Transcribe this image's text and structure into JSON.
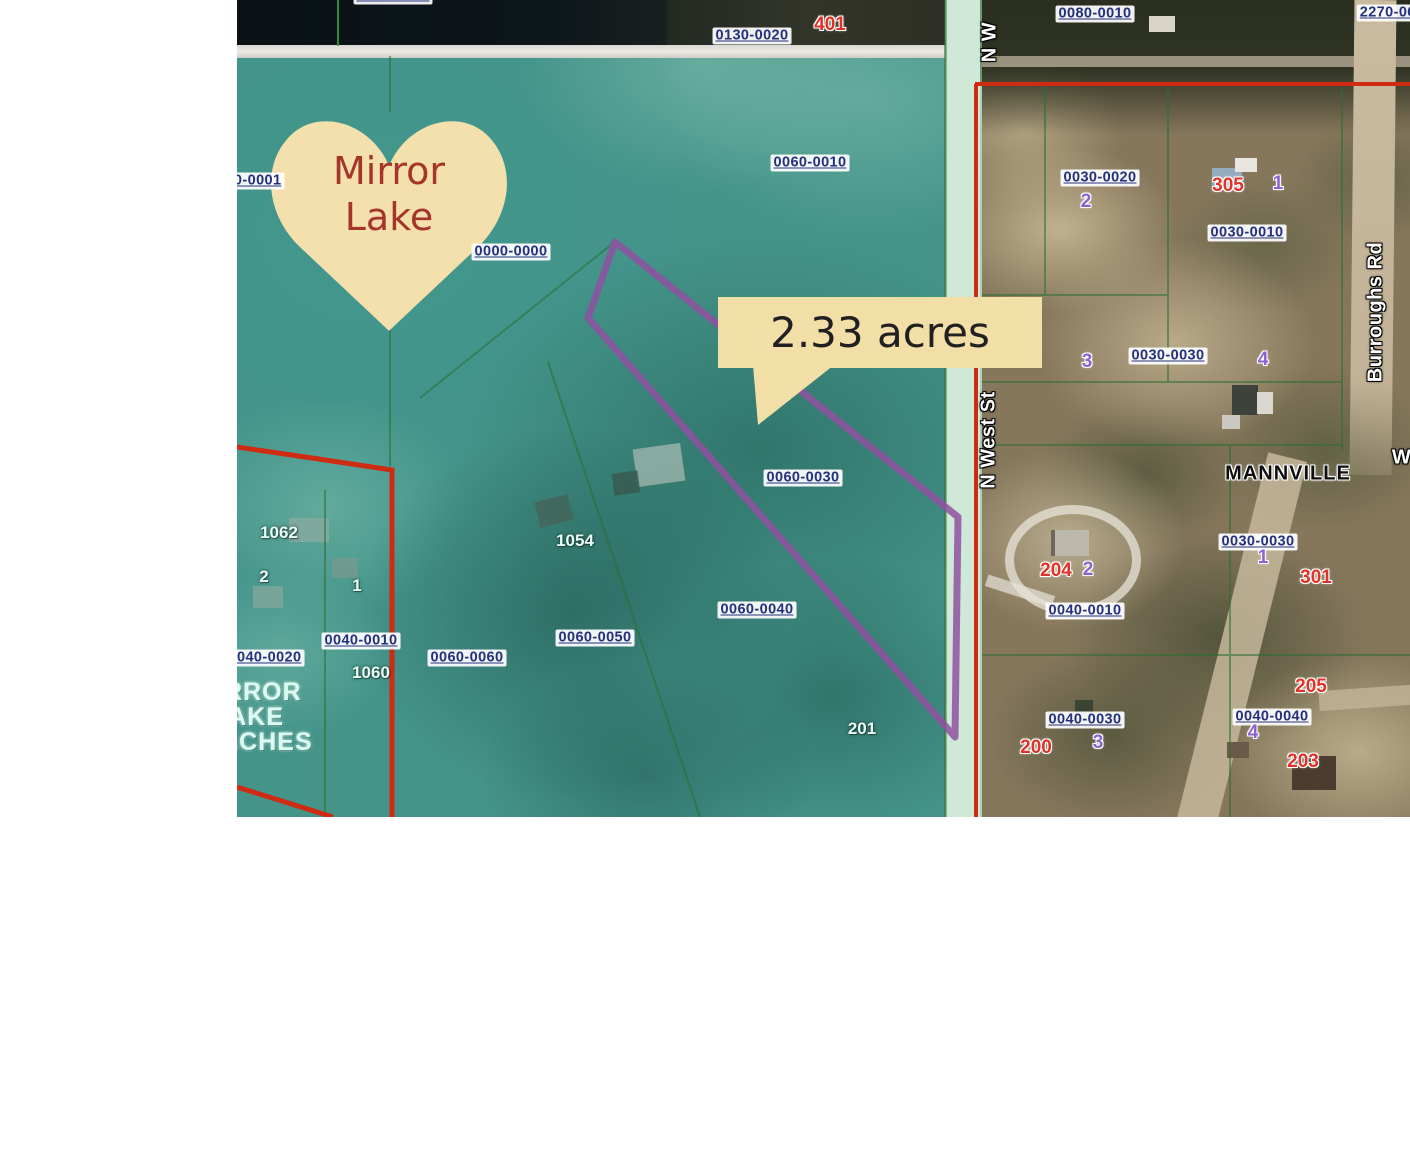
{
  "callout": {
    "text": "2.33 acres"
  },
  "heart": {
    "line1": "Mirror",
    "line2": "Lake"
  },
  "subdivision": {
    "line1": "MIRROR",
    "line2": "LAKE",
    "line3": "BEACHES"
  },
  "labels": [
    {
      "kind": "parcel",
      "text": "0130-0000",
      "x": 156,
      "y": -4
    },
    {
      "kind": "parcel",
      "text": "0130-0020",
      "x": 515,
      "y": 36
    },
    {
      "kind": "parcel",
      "text": "0080-0010",
      "x": 858,
      "y": 14
    },
    {
      "kind": "parcel",
      "text": "2270-060",
      "x": 1155,
      "y": 13
    },
    {
      "kind": "parcel",
      "text": "0000-0001",
      "x": 8,
      "y": 181
    },
    {
      "kind": "parcel",
      "text": "0060-0010",
      "x": 573,
      "y": 163
    },
    {
      "kind": "parcel",
      "text": "0000-0000",
      "x": 274,
      "y": 252
    },
    {
      "kind": "parcel",
      "text": "0030-0020",
      "x": 863,
      "y": 178
    },
    {
      "kind": "parcel",
      "text": "0030-0010",
      "x": 1010,
      "y": 233
    },
    {
      "kind": "parcel",
      "text": "0030-0030",
      "x": 931,
      "y": 356
    },
    {
      "kind": "parcel",
      "text": "0030-0030",
      "x": 1021,
      "y": 542
    },
    {
      "kind": "parcel",
      "text": "0040-0010",
      "x": 848,
      "y": 611
    },
    {
      "kind": "parcel",
      "text": "0040-0030",
      "x": 848,
      "y": 720
    },
    {
      "kind": "parcel",
      "text": "0040-0040",
      "x": 1035,
      "y": 717
    },
    {
      "kind": "parcel",
      "text": "0060-0030",
      "x": 566,
      "y": 478
    },
    {
      "kind": "parcel",
      "text": "0060-0040",
      "x": 520,
      "y": 610
    },
    {
      "kind": "parcel",
      "text": "0060-0050",
      "x": 358,
      "y": 638
    },
    {
      "kind": "parcel",
      "text": "0060-0060",
      "x": 230,
      "y": 658
    },
    {
      "kind": "parcel",
      "text": "0040-0010",
      "x": 124,
      "y": 641
    },
    {
      "kind": "parcel",
      "text": "0040-0020",
      "x": 28,
      "y": 658
    },
    {
      "kind": "red",
      "text": "401",
      "x": 593,
      "y": 25
    },
    {
      "kind": "red",
      "text": "305",
      "x": 991,
      "y": 186
    },
    {
      "kind": "red",
      "text": "204",
      "x": 819,
      "y": 571
    },
    {
      "kind": "red",
      "text": "301",
      "x": 1079,
      "y": 578
    },
    {
      "kind": "red",
      "text": "205",
      "x": 1074,
      "y": 687
    },
    {
      "kind": "red",
      "text": "200",
      "x": 799,
      "y": 748
    },
    {
      "kind": "red",
      "text": "203",
      "x": 1066,
      "y": 762
    },
    {
      "kind": "purple",
      "text": "2",
      "x": 849,
      "y": 202
    },
    {
      "kind": "purple",
      "text": "1",
      "x": 1041,
      "y": 184
    },
    {
      "kind": "purple",
      "text": "3",
      "x": 850,
      "y": 362
    },
    {
      "kind": "purple",
      "text": "4",
      "x": 1026,
      "y": 360
    },
    {
      "kind": "purple",
      "text": "2",
      "x": 851,
      "y": 570
    },
    {
      "kind": "purple",
      "text": "1",
      "x": 1026,
      "y": 558
    },
    {
      "kind": "purple",
      "text": "3",
      "x": 861,
      "y": 743
    },
    {
      "kind": "purple",
      "text": "4",
      "x": 1016,
      "y": 733
    },
    {
      "kind": "white",
      "text": "1062",
      "x": 42,
      "y": 533
    },
    {
      "kind": "white",
      "text": "2",
      "x": 27,
      "y": 577
    },
    {
      "kind": "white",
      "text": "1",
      "x": 120,
      "y": 586
    },
    {
      "kind": "white",
      "text": "1054",
      "x": 338,
      "y": 541
    },
    {
      "kind": "white",
      "text": "1060",
      "x": 134,
      "y": 673
    },
    {
      "kind": "white",
      "text": "201",
      "x": 625,
      "y": 729
    },
    {
      "kind": "street",
      "text": "N W",
      "x": 753,
      "y": 42,
      "rot": -90
    },
    {
      "kind": "street",
      "text": "N West St",
      "x": 752,
      "y": 440,
      "rot": -90
    },
    {
      "kind": "street",
      "text": "Burroughs Rd",
      "x": 1139,
      "y": 312,
      "rot": -90
    },
    {
      "kind": "street",
      "text": "Wa",
      "x": 1170,
      "y": 458
    },
    {
      "kind": "place",
      "text": "MANNVILLE",
      "x": 1051,
      "y": 474
    }
  ],
  "colors": {
    "overlay_teal": "#44948a",
    "road_mint": "#cfe8d7",
    "heart_fill": "#f4e0ad",
    "heart_text": "#a5352a",
    "callout_fill": "#f2dfa7",
    "callout_text": "#202020",
    "parcel_chip_text": "#23307e",
    "address_red": "#e23127",
    "lot_purple": "#8a63d2",
    "boundary_red": "#cf2a12",
    "selection_purple": "#8f51a1",
    "boundary_green": "#2c6e31"
  }
}
